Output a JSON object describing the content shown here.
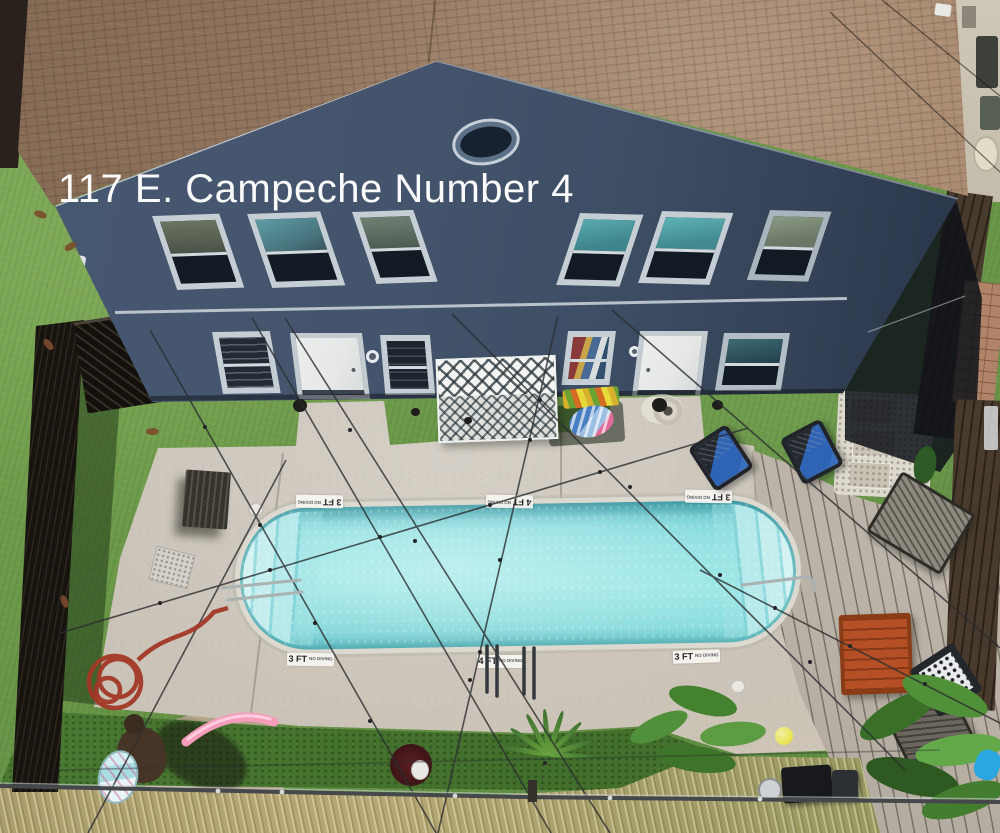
{
  "overlay": {
    "address": "117 E. Campeche Number 4"
  },
  "pool": {
    "markers_top": [
      {
        "depth": "3 FT",
        "note": "NO DIVING"
      },
      {
        "depth": "4 FT",
        "note": "NO DIVING"
      },
      {
        "depth": "3 FT",
        "note": "NO DIVING"
      }
    ],
    "markers_bottom": [
      {
        "depth": "3 FT",
        "note": "NO DIVING"
      },
      {
        "depth": "4 FT",
        "note": "NO DIVING"
      },
      {
        "depth": "3 FT",
        "note": "NO DIVING"
      }
    ]
  },
  "palette": {
    "grass": "#6f9c4b",
    "dry_grass": "#c3b183",
    "roof": "#9a7d64",
    "siding": "#40506a",
    "window_trim": "#c5ced4",
    "deck_concrete": "#c9c2b7",
    "deck_wood": "#bdb5a8",
    "coping": "#dcdad0",
    "water": "#8fdde0",
    "fence": "#17130f",
    "hose": "#a23827",
    "noodle": "#f59cba",
    "chair_blue": "#2f63b4",
    "table_wood": "#b55026"
  }
}
